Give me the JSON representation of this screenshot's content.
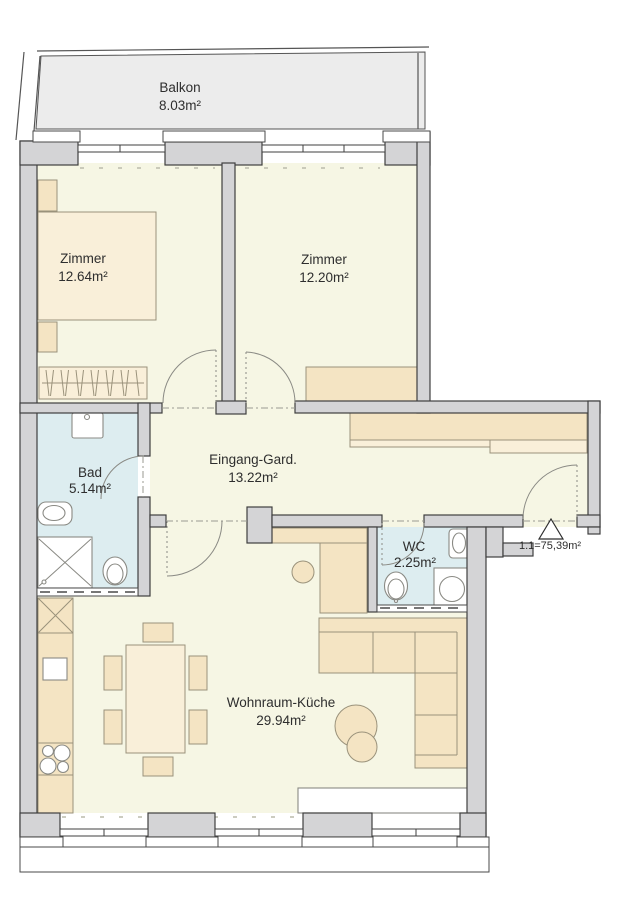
{
  "plan": {
    "rooms": [
      {
        "name": "Balkon",
        "area": "8.03m²"
      },
      {
        "name": "Zimmer",
        "area": "12.64m²"
      },
      {
        "name": "Zimmer",
        "area": "12.20m²"
      },
      {
        "name": "Bad",
        "area": "5.14m²"
      },
      {
        "name": "Eingang-Gard.",
        "area": "13.22m²"
      },
      {
        "name": "WC",
        "area": "2.25m²"
      },
      {
        "name": "Wohnraum-Küche",
        "area": "29.94m²"
      }
    ],
    "entrance_label": "1.1=75,39m²",
    "colors": {
      "wall": "#d4d4d6",
      "floor": "#f6f6e4",
      "wet_room": "#ddedf0",
      "furniture": "#f4e4c3",
      "balcony": "#ececec"
    }
  }
}
